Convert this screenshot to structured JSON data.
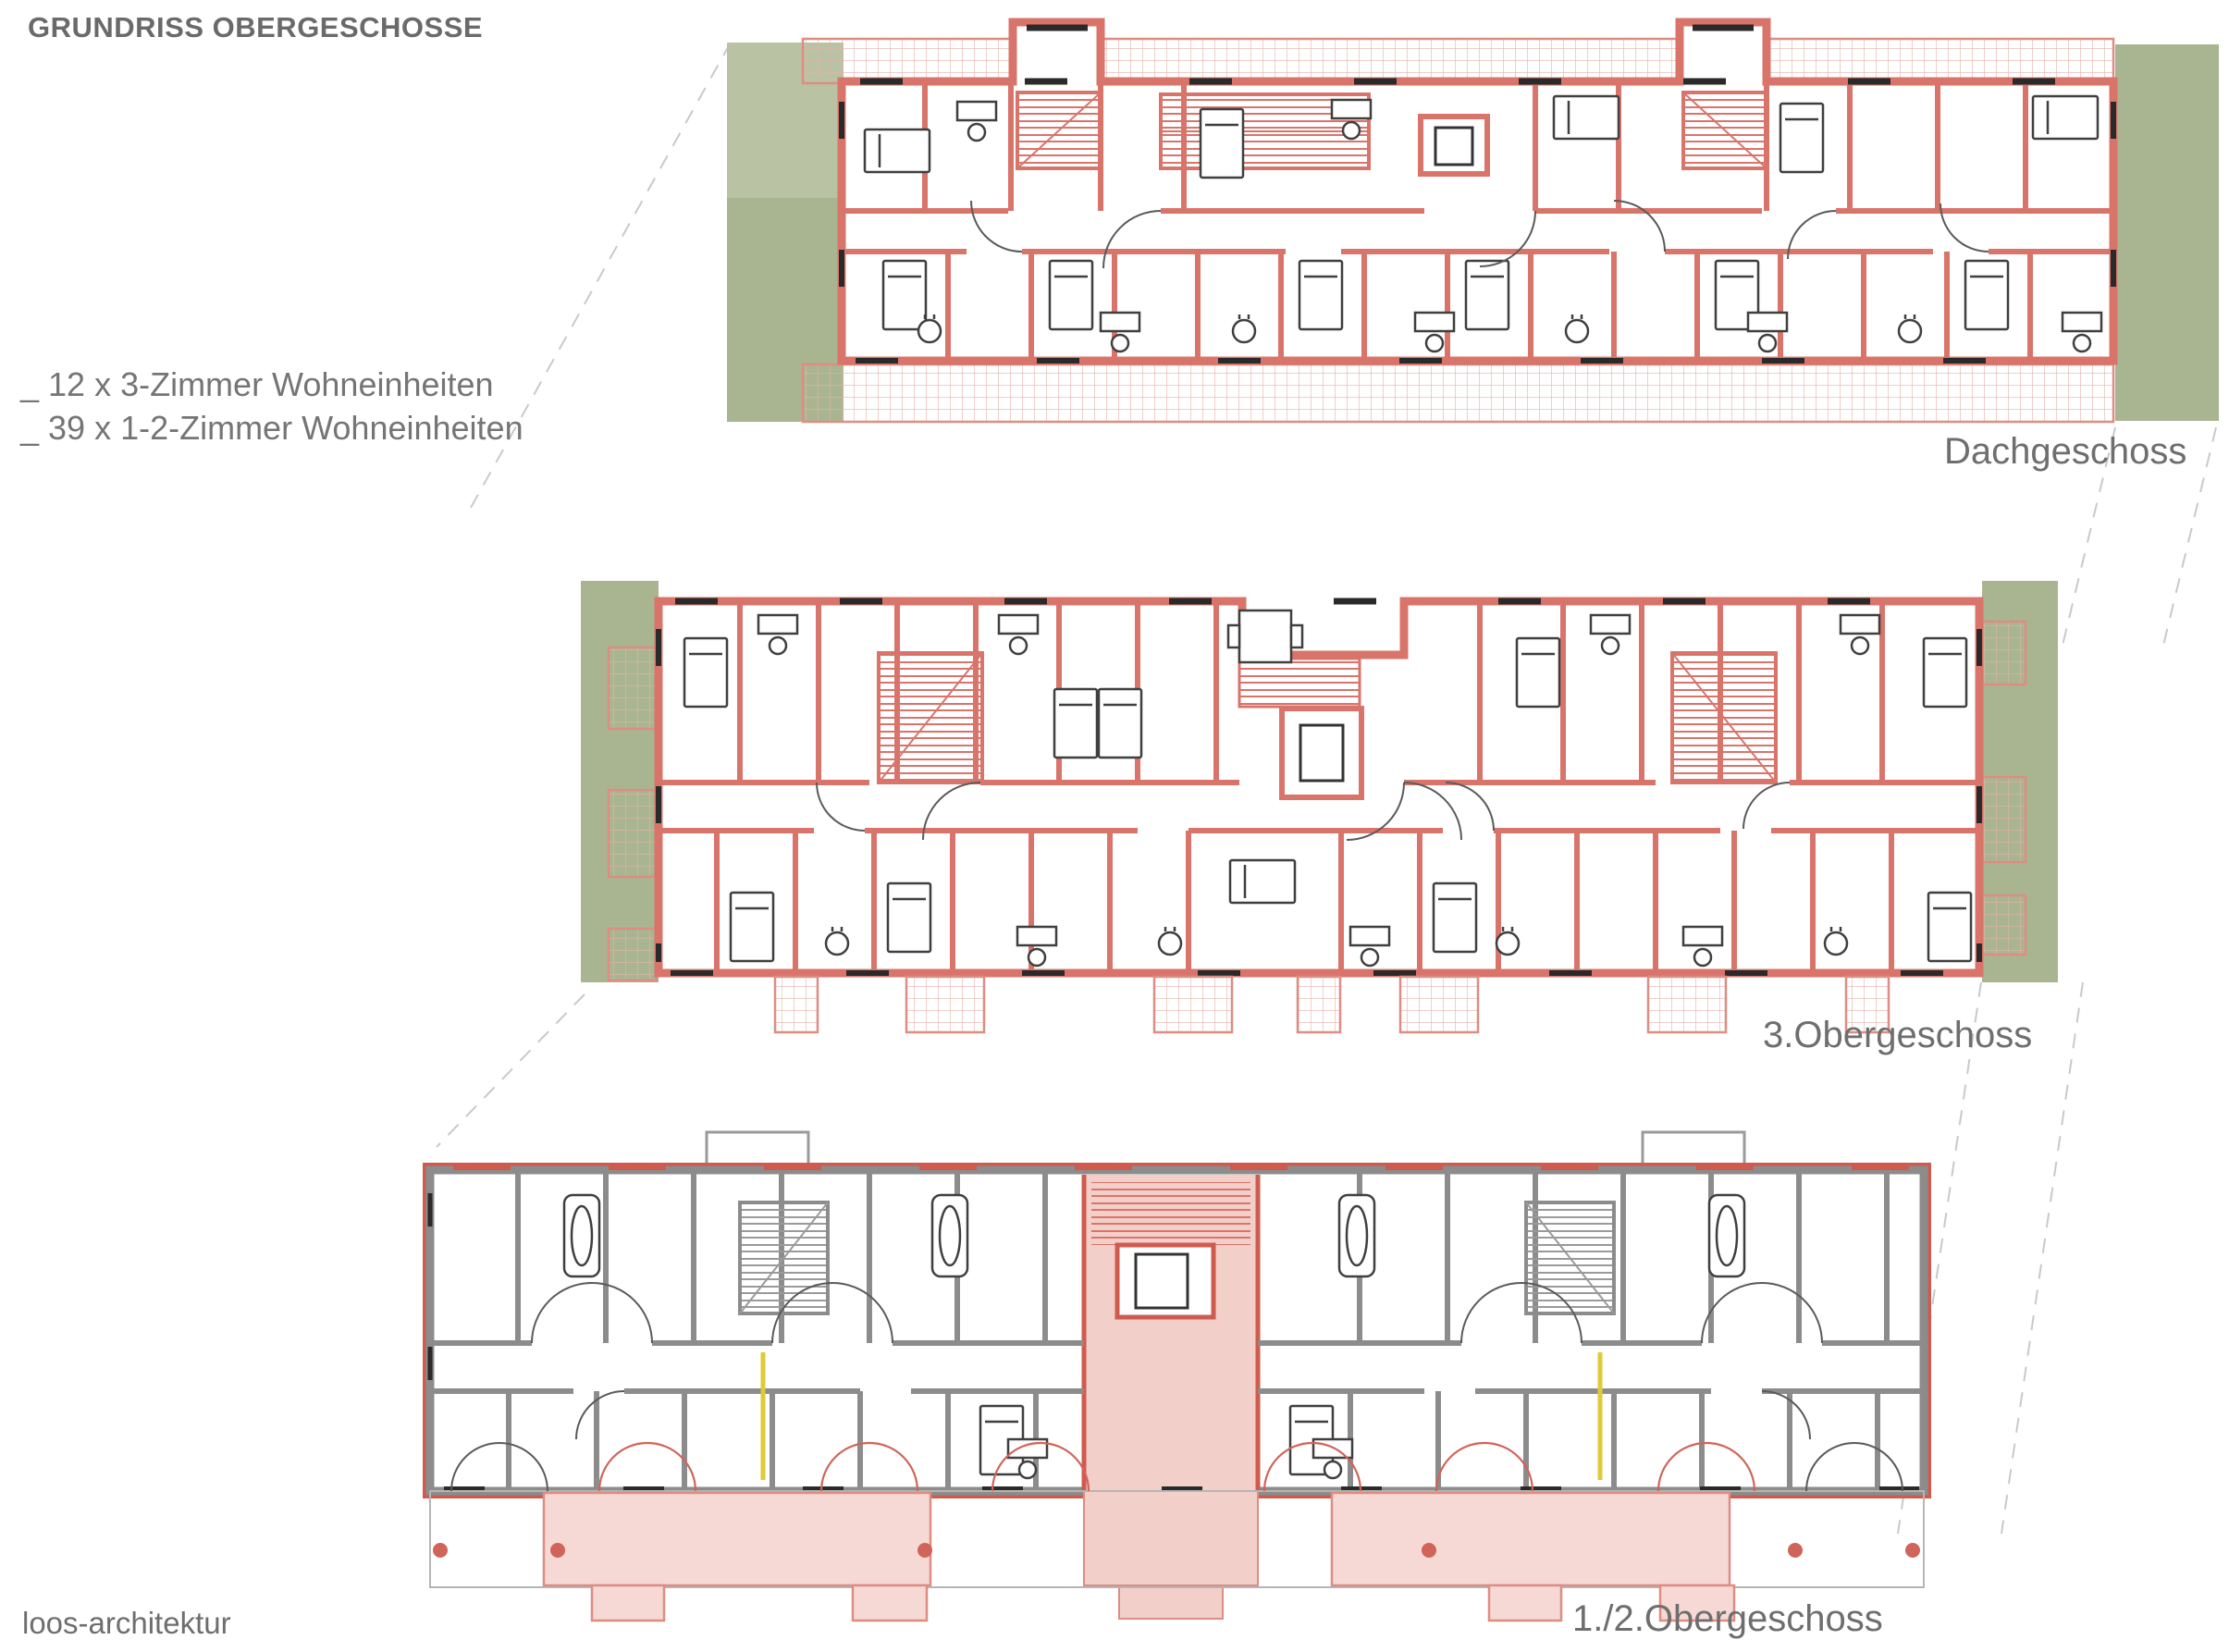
{
  "header": {
    "title": "GRUNDRISS OBERGESCHOSSE"
  },
  "legend": {
    "items": [
      {
        "label": "_ 12 x 3-Zimmer Wohneinheiten"
      },
      {
        "label": "_ 39 x 1-2-Zimmer Wohneinheiten"
      }
    ]
  },
  "floors": [
    {
      "id": "dachgeschoss",
      "label": "Dachgeschoss"
    },
    {
      "id": "obergeschoss3",
      "label": "3.Obergeschoss"
    },
    {
      "id": "obergeschoss12",
      "label": "1./2.Obergeschoss"
    }
  ],
  "footer": {
    "studio": "loos-architektur"
  },
  "colors": {
    "wall_red": "#d9746b",
    "red_accent": "#cf5b4f",
    "wall_gray": "#8c8c8c",
    "sage": "#a9b591",
    "sage_light": "#b9c3a4",
    "hatch_line": "#e3b2aa",
    "hatch_border": "#dd8d82",
    "pink_fill": "#f6d9d4",
    "pink_core": "#f3cfc9",
    "yellow": "#e0ca35",
    "dash": "#c9c9c9",
    "text": "#6a6a6a"
  }
}
